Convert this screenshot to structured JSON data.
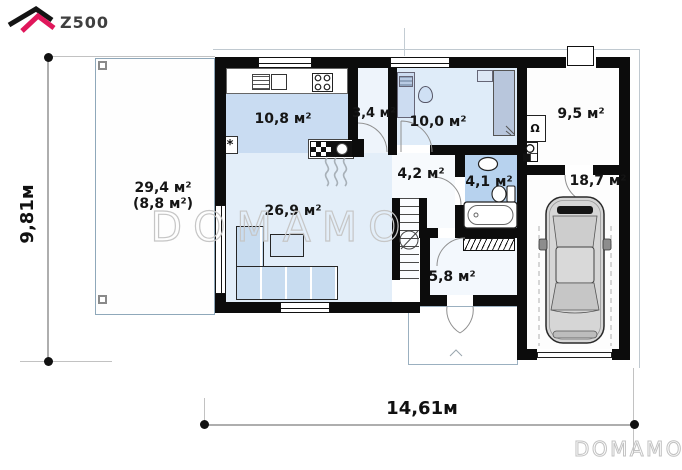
{
  "brand": {
    "name": "Z500"
  },
  "watermarks": {
    "center": "DOMAMO",
    "corner": "DOMAMO"
  },
  "dimensions": {
    "total_width": "14,61м",
    "total_height": "9,81м"
  },
  "rooms": [
    {
      "name": "terrace",
      "area": "29,4 м²",
      "area_alt": "(8,8 м²)"
    },
    {
      "name": "kitchen",
      "area": "10,8 м²"
    },
    {
      "name": "corridor",
      "area": "3,4 м²"
    },
    {
      "name": "cabinet",
      "area": "10,0 м²"
    },
    {
      "name": "boiler-room",
      "area": "9,5 м²"
    },
    {
      "name": "garage",
      "area": "18,7 м²"
    },
    {
      "name": "living-room",
      "area": "26,9 м²"
    },
    {
      "name": "hall",
      "area": "4,2 м²"
    },
    {
      "name": "bathroom",
      "area": "4,1 м²"
    },
    {
      "name": "vestibule",
      "area": "5,8 м²"
    }
  ],
  "symbols": {
    "fridge": "*",
    "boiler": "Ω"
  },
  "colors": {
    "accent": "#e0175b",
    "wall": "#0c0c0c",
    "floor_blue": "#c9dcf2",
    "floor_light": "#e3eef9",
    "bath_blue": "#b7d2ee"
  }
}
